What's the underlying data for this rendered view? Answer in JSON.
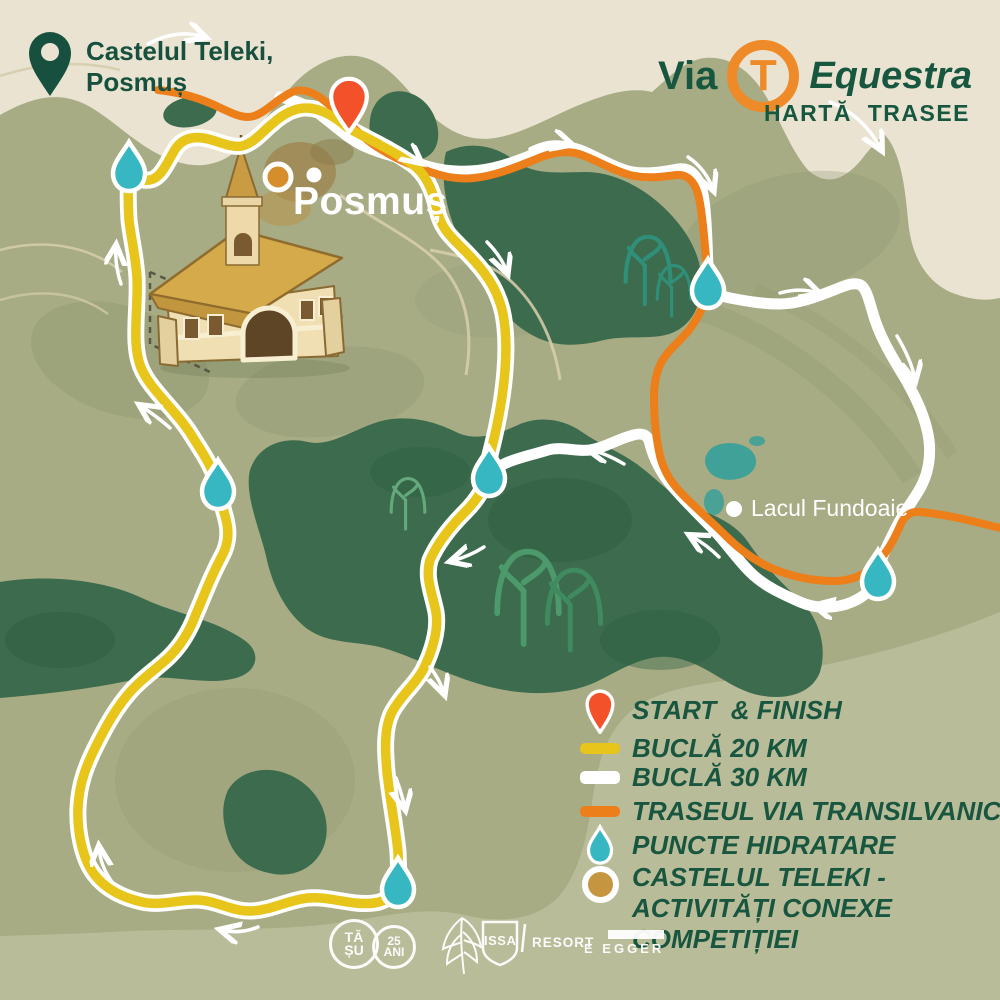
{
  "header": {
    "location": {
      "line1": "Castelul Teleki,",
      "line2": "Posmuș"
    },
    "brand": {
      "via": "Via",
      "logo_letter": "T",
      "name": "Equestra",
      "subtitle": "HARTĂ  TRASEE"
    }
  },
  "map": {
    "village_label": "Posmuș",
    "lake_label": "Lacul Fundoaie"
  },
  "legend": {
    "items": [
      {
        "id": "start-finish",
        "label": "START  & FINISH"
      },
      {
        "id": "loop-20km",
        "label": "BUCLĂ 20 KM"
      },
      {
        "id": "loop-30km",
        "label": "BUCLĂ 30 KM"
      },
      {
        "id": "via-transilvanica",
        "label": "TRASEUL VIA TRANSILVANICA"
      },
      {
        "id": "hydration-points",
        "label": "PUNCTE HIDRATARE"
      },
      {
        "id": "castle-activities",
        "label": "CASTELUL TELEKI - ACTIVITĂȚI CONEXE COMPETIȚIEI"
      }
    ]
  },
  "footer": {
    "tasu": {
      "c1a": "TĂ",
      "c1b": "ȘU",
      "c2a": "25",
      "c2b": "ANI"
    },
    "issa": {
      "shield_text": "ISSA",
      "resort_text": "RESORT"
    },
    "egger": {
      "text": "E EGGER"
    }
  },
  "colors": {
    "background": "#eae3d1",
    "land": "#a7ac84",
    "land_light": "#b9bc99",
    "forest": "#3c6b4d",
    "forest_deep": "#2e5e41",
    "lake": "#3fa197",
    "trail_20km": "#e7c51b",
    "trail_30km": "#ffffff",
    "trail_via_transilvanica": "#ec7f1a",
    "hydration": "#36b7c1",
    "start_pin": "#f2512a",
    "castle_marker": "#d68d2c",
    "text_green": "#19563f"
  }
}
